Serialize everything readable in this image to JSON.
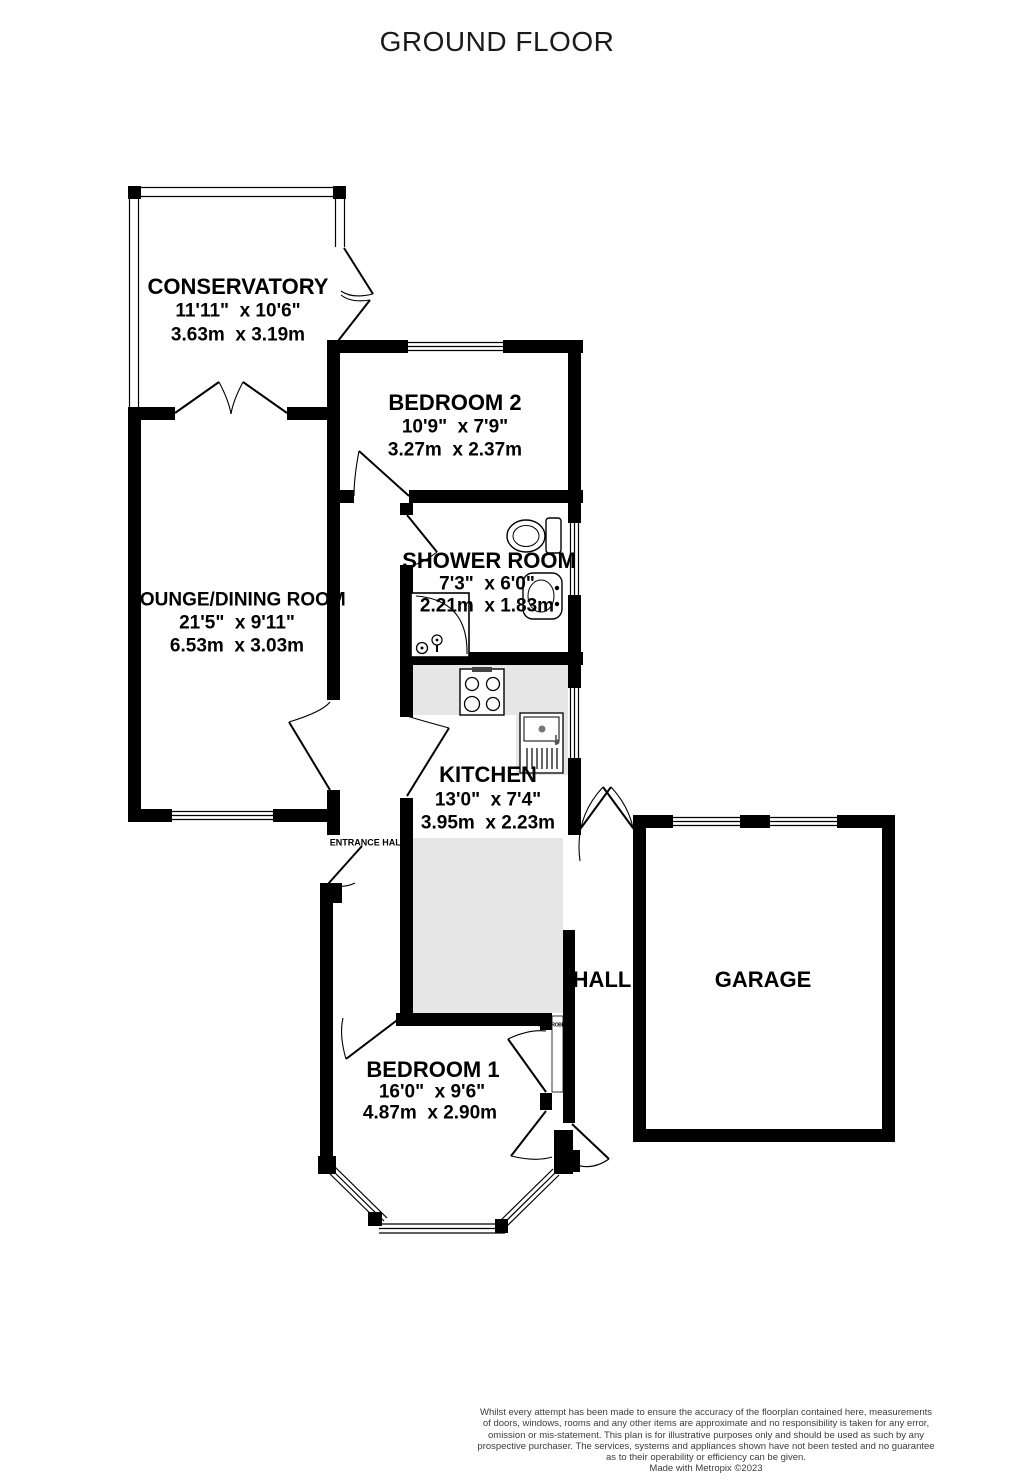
{
  "title": "GROUND FLOOR",
  "rooms": {
    "conservatory": {
      "name": "CONSERVATORY",
      "dims_imperial": "11'11\"  x 10'6\"",
      "dims_metric": "3.63m  x 3.19m"
    },
    "bedroom2": {
      "name": "BEDROOM 2",
      "dims_imperial": "10'9\"  x 7'9\"",
      "dims_metric": "3.27m  x 2.37m"
    },
    "shower_room": {
      "name": "SHOWER ROOM",
      "dims_imperial": "7'3\"  x 6'0\"",
      "dims_metric": "2.21m  x 1.83m"
    },
    "lounge_dining": {
      "name": "LOUNGE/DINING ROOM",
      "dims_imperial": "21'5\"  x 9'11\"",
      "dims_metric": "6.53m  x 3.03m"
    },
    "kitchen": {
      "name": "KITCHEN",
      "dims_imperial": "13'0\"  x 7'4\"",
      "dims_metric": "3.95m  x 2.23m"
    },
    "bedroom1": {
      "name": "BEDROOM 1",
      "dims_imperial": "16'0\"  x 9'6\"",
      "dims_metric": "4.87m  x 2.90m"
    },
    "hall": {
      "name": "HALL"
    },
    "garage": {
      "name": "GARAGE"
    },
    "entrance_hall": {
      "name": "ENTRANCE HALL"
    },
    "wardrobe": {
      "name": "WARDROBE"
    }
  },
  "footer": {
    "lines": [
      "Whilst every attempt has been made to ensure the accuracy of the floorplan contained here, measurements",
      "of doors, windows, rooms and any other items are approximate and no responsibility is taken for any error,",
      "omission or mis-statement. This plan is for illustrative purposes only and should be used as such by any",
      "prospective purchaser. The services, systems and appliances shown have not been tested and no guarantee",
      "as to their operability or efficiency can be given.",
      "Made with Metropix ©2023"
    ]
  },
  "colors": {
    "wall": "#000000",
    "kitchen_floor": "#e6e6e6",
    "background": "#ffffff",
    "footer_text": "#3c3c3c"
  }
}
